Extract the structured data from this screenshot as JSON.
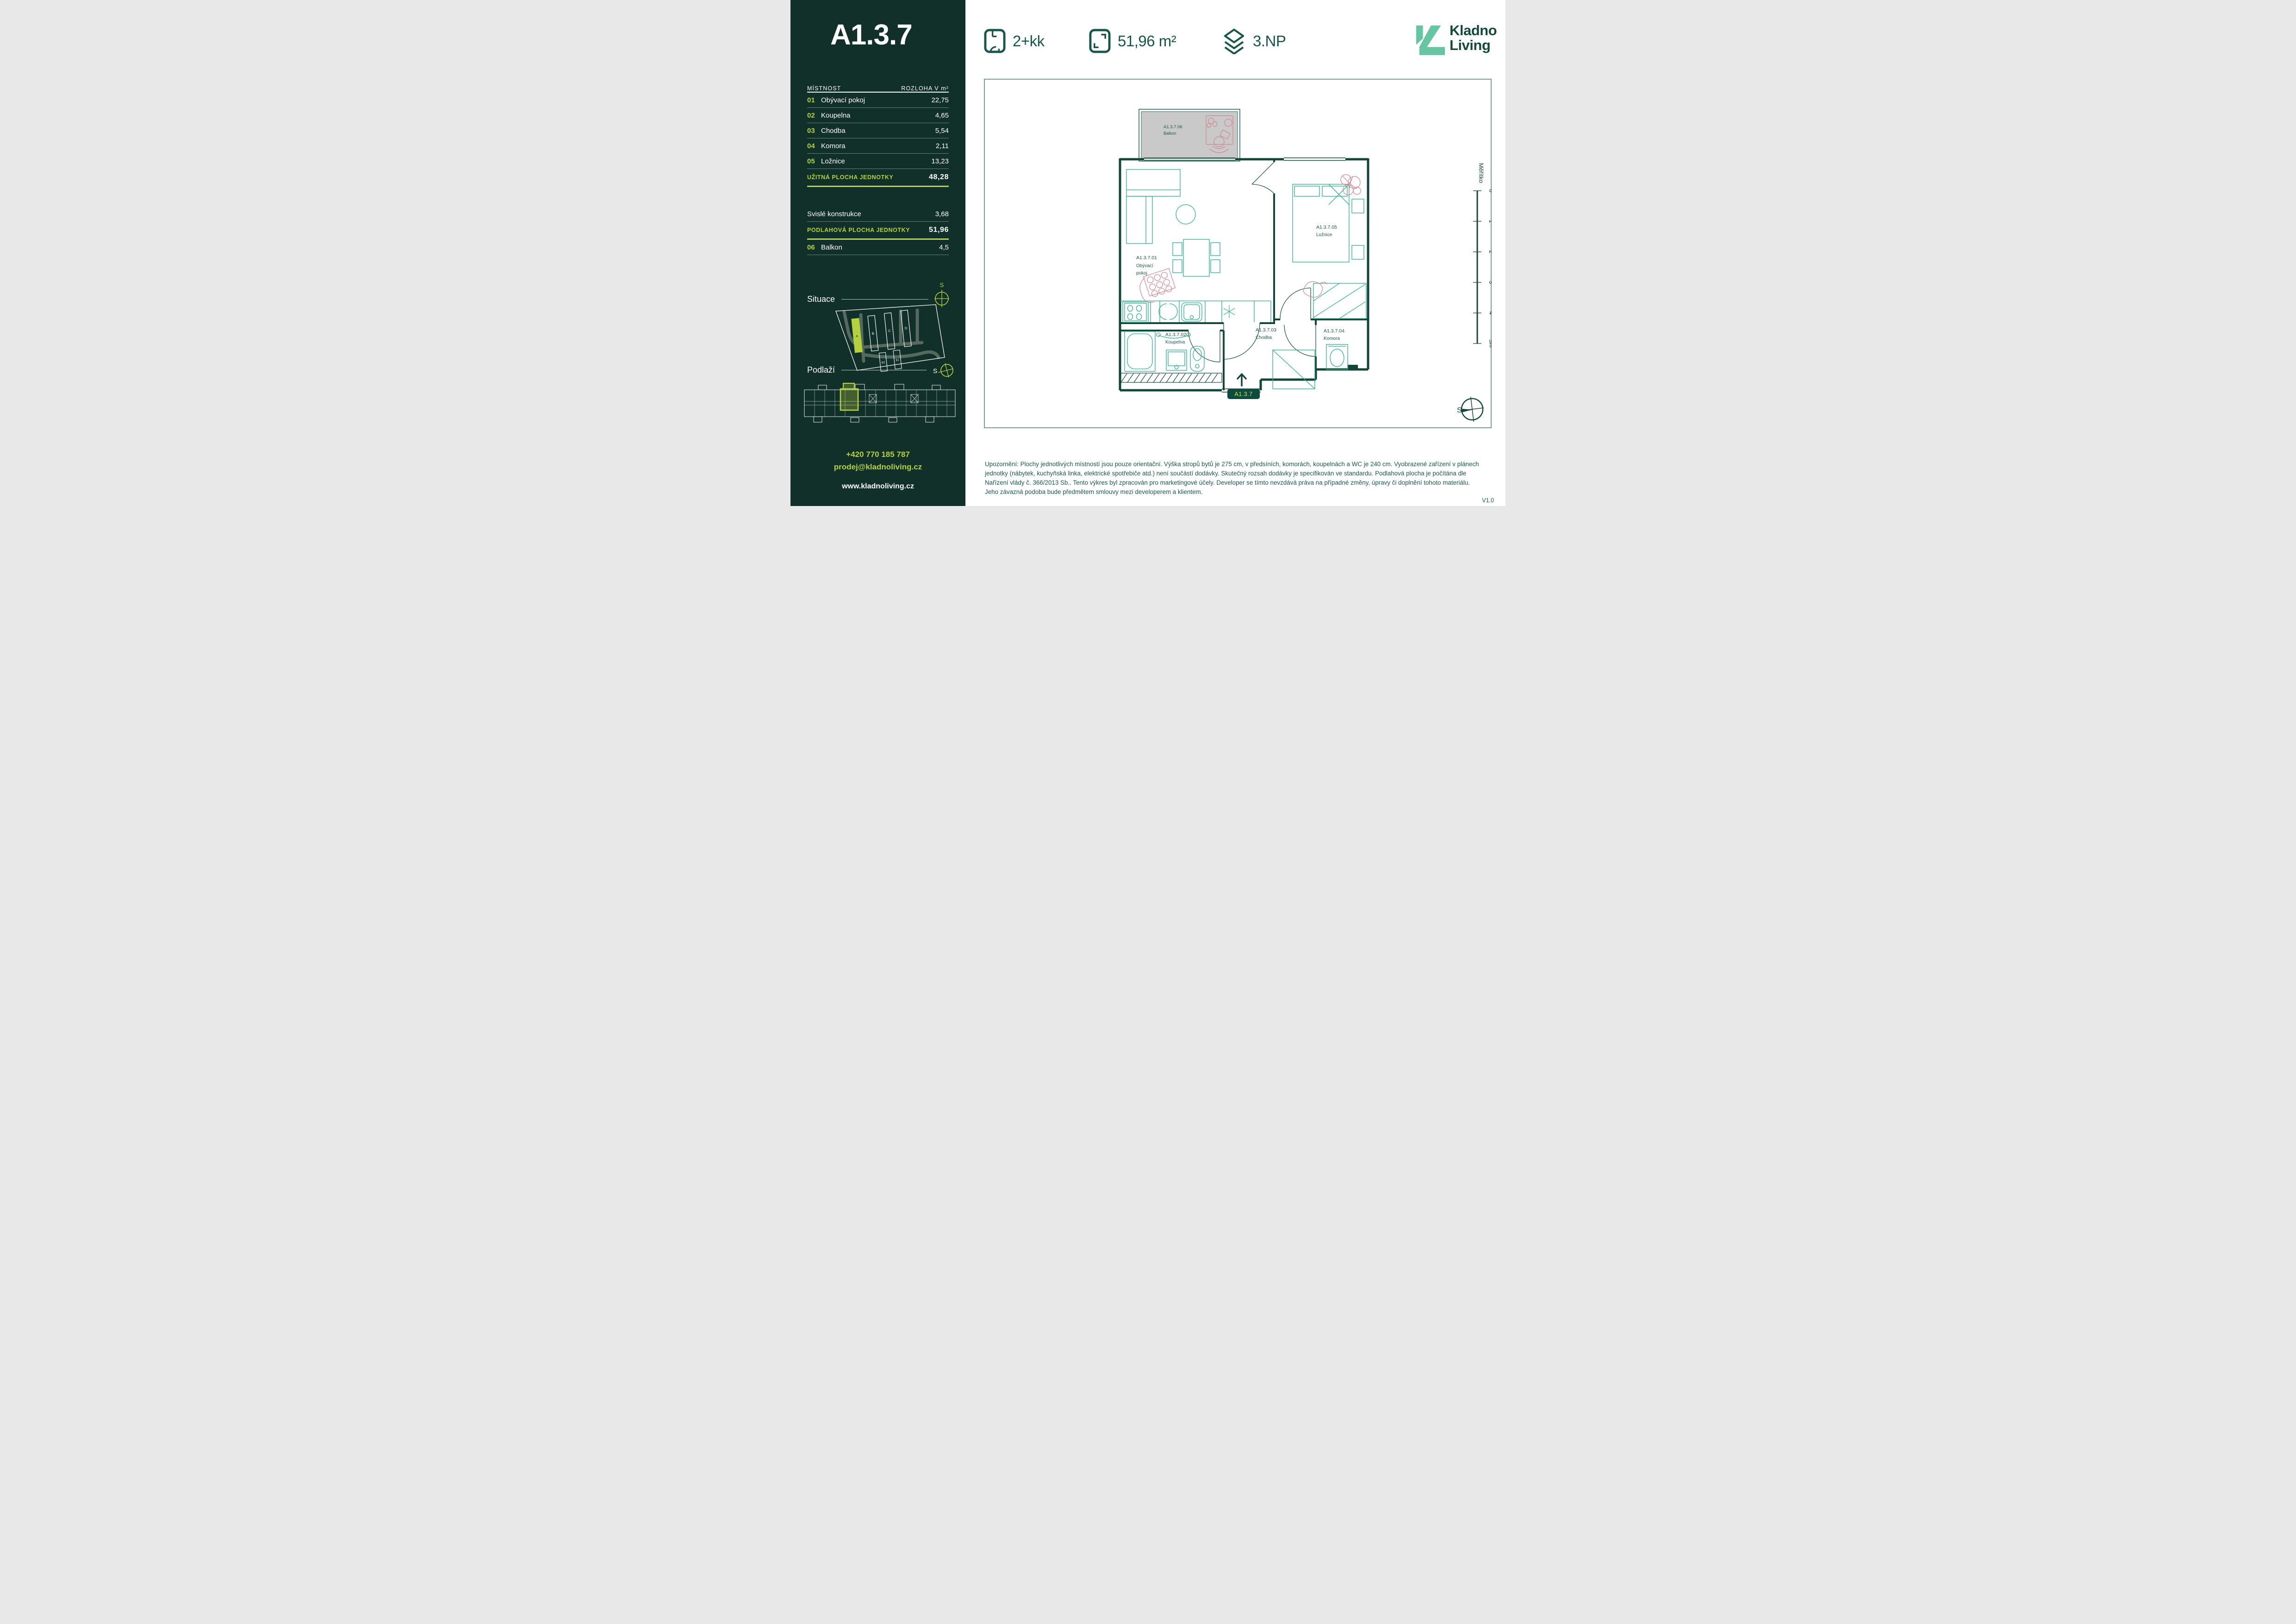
{
  "unit": {
    "id": "A1.3.7",
    "layout": "2+kk",
    "area": "51,96 m²",
    "floor": "3.NP",
    "badge": "A1.3.7",
    "version": "V1.0"
  },
  "logo": {
    "line1": "Kladno",
    "line2": "Living"
  },
  "sidebar": {
    "table": {
      "col_room": "MÍSTNOST",
      "col_area": "ROZLOHA V m²",
      "rows": [
        {
          "num": "01",
          "name": "Obývací pokoj",
          "value": "22,75"
        },
        {
          "num": "02",
          "name": "Koupelna",
          "value": "4,65"
        },
        {
          "num": "03",
          "name": "Chodba",
          "value": "5,54"
        },
        {
          "num": "04",
          "name": "Komora",
          "value": "2,11"
        },
        {
          "num": "05",
          "name": "Ložnice",
          "value": "13,23"
        }
      ],
      "usable": {
        "label": "UŽITNÁ PLOCHA JEDNOTKY",
        "value": "48,28"
      },
      "vertical": {
        "label": "Svislé konstrukce",
        "value": "3,68"
      },
      "floor_area": {
        "label": "PODLAHOVÁ PLOCHA JEDNOTKY",
        "value": "51,96"
      },
      "balcony": {
        "num": "06",
        "name": "Balkon",
        "value": "4,5"
      }
    },
    "situace_label": "Situace",
    "podlazi_label": "Podlaží",
    "compass_letter": "S",
    "site": {
      "buildings": [
        "A",
        "B",
        "C",
        "D",
        "E2",
        "E1"
      ]
    },
    "contact": {
      "phone": "+420 770 185 787",
      "email": "prodej@kladnoliving.cz",
      "web": "www.kladnoliving.cz"
    }
  },
  "plan": {
    "rooms": {
      "balkon": {
        "code": "A1.3.7.06",
        "name": "Balkon"
      },
      "obyvaci": {
        "code": "A1.3.7.01",
        "name_line1": "Obývací",
        "name_line2": "pokoj"
      },
      "koupelna": {
        "code": "A1.3.7.02",
        "name": "Koupelna"
      },
      "chodba": {
        "code": "A1.3.7.03",
        "name": "Chodba"
      },
      "komora": {
        "code": "A1.3.7.04",
        "name": "Komora"
      },
      "loznice": {
        "code": "A1.3.7.05",
        "name": "Ložnice"
      }
    },
    "scale": {
      "label": "Měřítko",
      "ticks": [
        "0",
        "1",
        "2",
        "3",
        "4",
        "5m"
      ]
    },
    "compass_letter": "S"
  },
  "disclaimer": {
    "lines": [
      "Upozornění: Plochy jednotlivých místností jsou pouze orientační. Výška stropů bytů je 275 cm, v předsíních, komorách, koupelnách a WC je 240 cm. Vyobrazené zařízení v plánech",
      "jednotky (nábytek, kuchyňská linka, elektrické spotřebiče atd.) není součástí dodávky. Skutečný rozsah dodávky je specifikován ve standardu. Podlahová plocha je počítána dle",
      "Nařízení vlády č. 366/2013 Sb.. Tento výkres byl zpracován pro marketingové účely. Developer se tímto nevzdává práva na případné změny, úpravy či doplnění tohoto materiálu.",
      "Jeho závazná podoba bude předmětem smlouvy mezi developerem a klientem."
    ]
  },
  "colors": {
    "sidebar_bg": "#113029",
    "accent": "#b4d13f",
    "ink": "#19564a",
    "wall": "#134539",
    "furniture": "#2daf8e",
    "pink": "#d4838f",
    "balcony_fill": "#c9c9c9",
    "logo_mint": "#66c6a2",
    "badge_bg": "#0f4a3e",
    "badge_text": "#d9df5b"
  }
}
